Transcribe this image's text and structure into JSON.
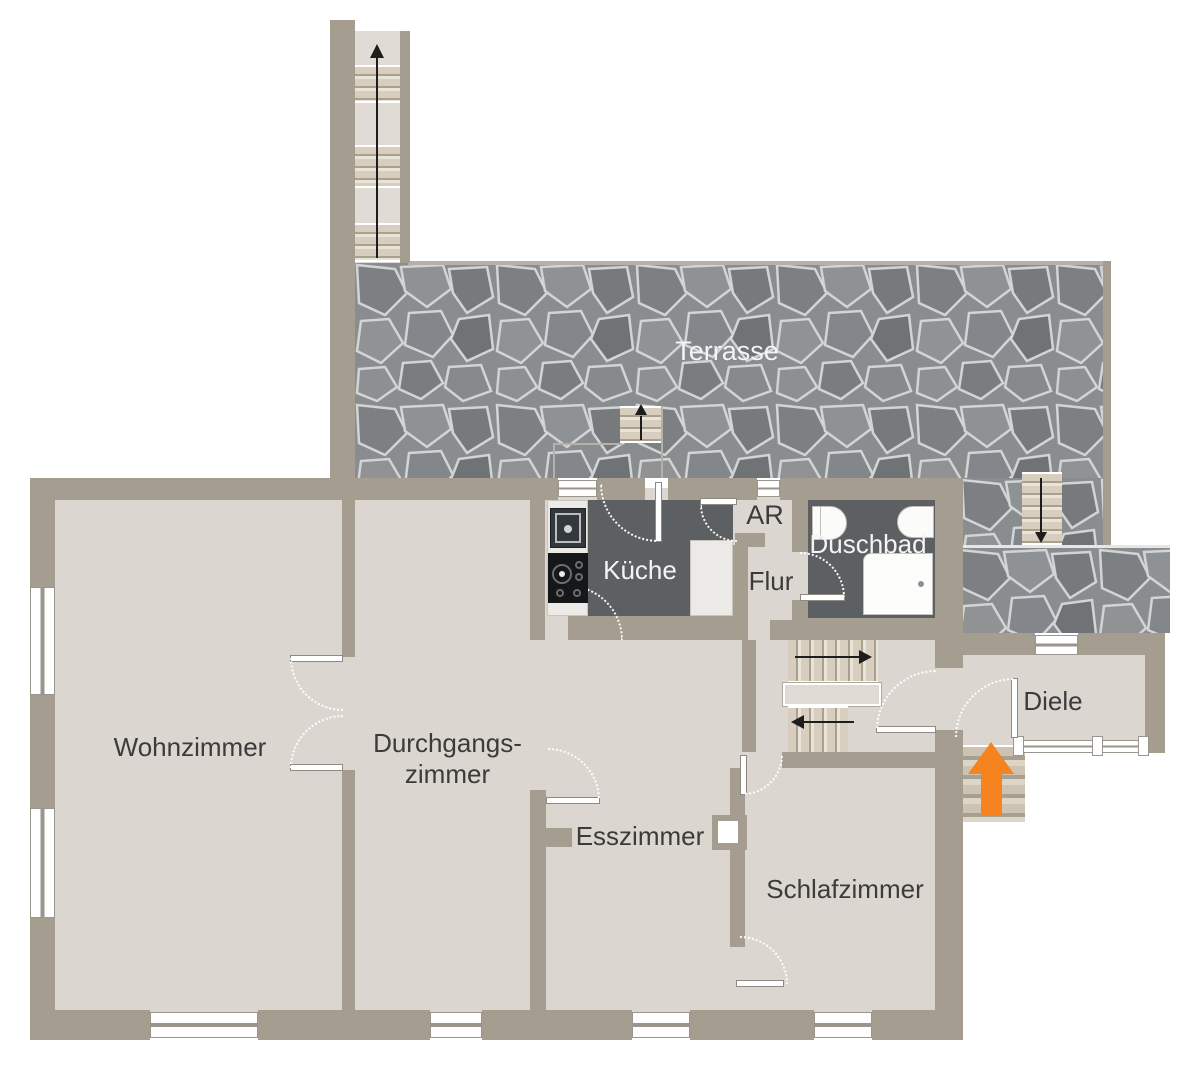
{
  "title": "Grundriss Wohnung (floor plan)",
  "labels": {
    "terrasse": "Terrasse",
    "kueche": "Küche",
    "ar": "AR",
    "duschbad": "Duschbad",
    "flur": "Flur",
    "diele": "Diele",
    "wohnzimmer": "Wohnzimmer",
    "durchgangszimmer_line1": "Durchgangs-",
    "durchgangszimmer_line2": "zimmer",
    "esszimmer": "Esszimmer",
    "schlafzimmer": "Schlafzimmer"
  },
  "arrows": {
    "exterior_staircase_top": "up",
    "terrace_kitchen_stairs": "up",
    "terrace_right_stairs": "down",
    "interior_stairs_upper_flight": "right",
    "interior_stairs_lower_flight": "left",
    "main_entrance": "up"
  },
  "colors": {
    "wall": "#a69d91",
    "floor": "#dbd7d0",
    "floor-dark": "#5d6062",
    "tread": "#d7cebf",
    "tread-line": "#aaa08e",
    "arrow-accent": "#f5831f",
    "label": "#3b3b3b",
    "label-light": "#f4f4f4"
  }
}
